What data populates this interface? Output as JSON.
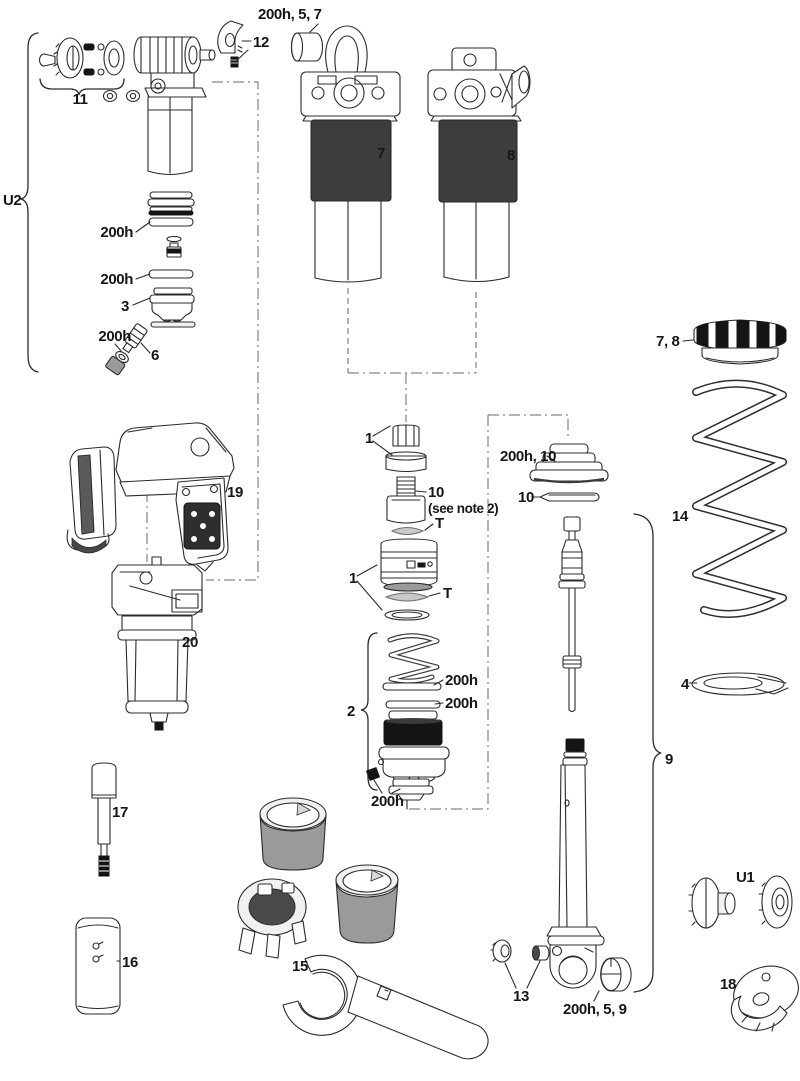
{
  "diagram": {
    "type": "exploded-parts-diagram",
    "subject": "rear shock service exploded view",
    "colors": {
      "background": "#ffffff",
      "line": "#2b2b2b",
      "dark_band": "#3d3d3d",
      "black_part": "#141414",
      "dash_line": "#6a6a6a"
    }
  },
  "labels": {
    "u2_group": "U2",
    "knob_group": "11",
    "lever_clamp": "12",
    "top_bushing": "200h, 5, 7",
    "gland_ring_a": "200h",
    "gland_ring_b": "200h",
    "seal_head": "3",
    "valve_oring": "200h",
    "valve": "6",
    "shock_left": "7",
    "shock_right": "8",
    "preload_ring": "7, 8",
    "valve_cap_group": "1",
    "seal_plug": "10",
    "seal_plug_note": "(see note 2)",
    "t_ring_upper": "T",
    "wiper_group": "200h, 10",
    "wiper_ring": "10",
    "coil_spring": "14",
    "air_can_group": "1",
    "t_ring_lower": "T",
    "piston_group": "2",
    "piston_oring_a": "200h",
    "piston_oring_b": "200h",
    "piston_seal": "200h",
    "shaft_group": "9",
    "spring_retainer": "4",
    "remote_module": "19",
    "damper_body": "20",
    "tool_shaft": "17",
    "plate": "16",
    "wrench_group": "15",
    "fittings": "13",
    "eyelet_bushing": "200h, 5, 9",
    "u1_knobs": "U1",
    "bottom_cup": "18"
  }
}
